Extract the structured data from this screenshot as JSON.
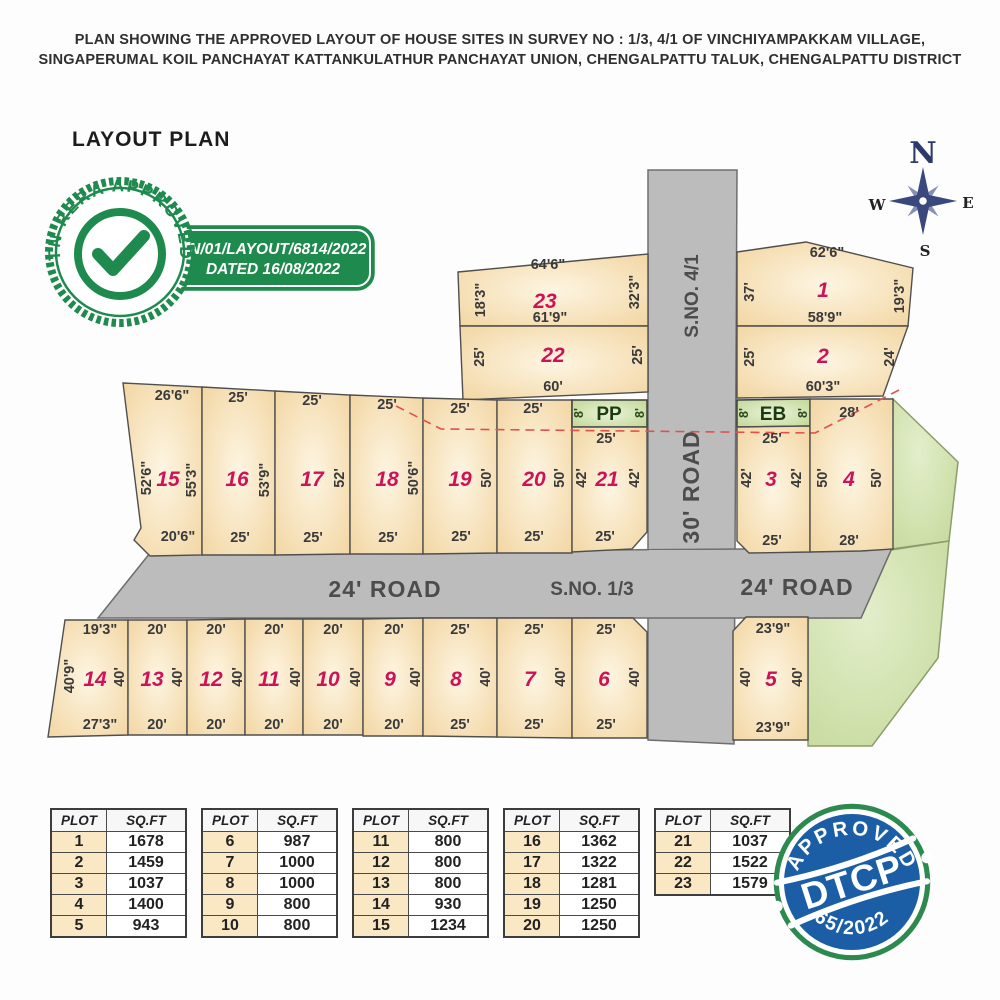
{
  "header": {
    "line1": "PLAN SHOWING THE APPROVED LAYOUT OF HOUSE SITES IN SURVEY NO : 1/3, 4/1 OF VINCHIYAMPAKKAM VILLAGE,",
    "line2": "SINGAPERUMAL KOIL PANCHAYAT KATTANKULATHUR PANCHAYAT UNION, CHENGALPATTU TALUK, CHENGALPATTU DISTRICT"
  },
  "layout_title": "LAYOUT PLAN",
  "rera": {
    "seal_text": "TN RERA APPROVED",
    "line1": "TN/01/LAYOUT/6814/2022",
    "line2": "DATED 16/08/2022"
  },
  "dtcp": {
    "approved": "APPROVED",
    "name": "DTCP",
    "number": "65/2022"
  },
  "compass": {
    "n": "N",
    "e": "E",
    "s": "S",
    "w": "W"
  },
  "roads": {
    "survey_41": "S.NO. 4/1",
    "road_30": "30' ROAD",
    "road_24_left": "24' ROAD",
    "survey_13": "S.NO. 1/3",
    "road_24_right": "24' ROAD"
  },
  "strips": {
    "pp": {
      "label": "PP",
      "left": "8'",
      "right": "8'"
    },
    "eb": {
      "label": "EB",
      "left": "8'",
      "right": "8'"
    }
  },
  "plots": {
    "p1": {
      "no": "1",
      "top": "62'6\"",
      "left": "37'",
      "right": "19'3\"",
      "bottom": "58'9\""
    },
    "p2": {
      "no": "2",
      "left": "25'",
      "right": "24'",
      "bottom": "60'3\""
    },
    "p3": {
      "no": "3",
      "top": "25'",
      "left": "42'",
      "right": "42'",
      "bottom": "25'"
    },
    "p4": {
      "no": "4",
      "top": "28'",
      "left": "50'",
      "right": "50'",
      "bottom": "28'"
    },
    "p5": {
      "no": "5",
      "top": "23'9\"",
      "left": "40'",
      "right": "40'",
      "bottom": "23'9\""
    },
    "p6": {
      "no": "6",
      "top": "25'",
      "right": "40'",
      "bottom": "25'"
    },
    "p7": {
      "no": "7",
      "top": "25'",
      "right": "40'",
      "bottom": "25'"
    },
    "p8": {
      "no": "8",
      "top": "25'",
      "right": "40'",
      "bottom": "25'"
    },
    "p9": {
      "no": "9",
      "top": "20'",
      "right": "40'",
      "bottom": "20'"
    },
    "p10": {
      "no": "10",
      "top": "20'",
      "right": "40'",
      "bottom": "20'"
    },
    "p11": {
      "no": "11",
      "top": "20'",
      "right": "40'",
      "bottom": "20'"
    },
    "p12": {
      "no": "12",
      "top": "20'",
      "right": "40'",
      "bottom": "20'"
    },
    "p13": {
      "no": "13",
      "top": "20'",
      "right": "40'",
      "bottom": "20'"
    },
    "p14": {
      "no": "14",
      "top": "19'3\"",
      "left": "40'9\"",
      "right": "40'",
      "bottom": "27'3\""
    },
    "p15": {
      "no": "15",
      "top": "26'6\"",
      "left": "52'6\"",
      "right": "55'3\"",
      "bottom": "20'6\""
    },
    "p16": {
      "no": "16",
      "top": "25'",
      "right": "53'9\"",
      "bottom": "25'"
    },
    "p17": {
      "no": "17",
      "top": "25'",
      "right": "52'",
      "bottom": "25'"
    },
    "p18": {
      "no": "18",
      "top": "25'",
      "right": "50'6\"",
      "bottom": "25'"
    },
    "p19": {
      "no": "19",
      "top": "25'",
      "right": "50'",
      "bottom": "25'"
    },
    "p20": {
      "no": "20",
      "top": "25'",
      "right": "50'",
      "bottom": "25'"
    },
    "p21": {
      "no": "21",
      "top": "25'",
      "left": "42'",
      "right": "42'",
      "bottom": "25'"
    },
    "p22": {
      "no": "22",
      "left": "25'",
      "right": "25'",
      "bottom": "60'"
    },
    "p23": {
      "no": "23",
      "top": "64'6\"",
      "left": "18'3\"",
      "right": "32'3\"",
      "bottom": "61'9\""
    }
  },
  "tables": [
    {
      "headers": [
        "PLOT",
        "SQ.FT"
      ],
      "rows": [
        [
          "1",
          "1678"
        ],
        [
          "2",
          "1459"
        ],
        [
          "3",
          "1037"
        ],
        [
          "4",
          "1400"
        ],
        [
          "5",
          "943"
        ]
      ]
    },
    {
      "headers": [
        "PLOT",
        "SQ.FT"
      ],
      "rows": [
        [
          "6",
          "987"
        ],
        [
          "7",
          "1000"
        ],
        [
          "8",
          "1000"
        ],
        [
          "9",
          "800"
        ],
        [
          "10",
          "800"
        ]
      ]
    },
    {
      "headers": [
        "PLOT",
        "SQ.FT"
      ],
      "rows": [
        [
          "11",
          "800"
        ],
        [
          "12",
          "800"
        ],
        [
          "13",
          "800"
        ],
        [
          "14",
          "930"
        ],
        [
          "15",
          "1234"
        ]
      ]
    },
    {
      "headers": [
        "PLOT",
        "SQ.FT"
      ],
      "rows": [
        [
          "16",
          "1362"
        ],
        [
          "17",
          "1322"
        ],
        [
          "18",
          "1281"
        ],
        [
          "19",
          "1250"
        ],
        [
          "20",
          "1250"
        ]
      ]
    },
    {
      "headers": [
        "PLOT",
        "SQ.FT"
      ],
      "rows": [
        [
          "21",
          "1037"
        ],
        [
          "22",
          "1522"
        ],
        [
          "23",
          "1579"
        ]
      ]
    }
  ],
  "colors": {
    "plot_number": "#ce1257",
    "rera_green": "#1f8a4d",
    "dtcp_blue": "#1b5ea6",
    "plot_fill": "#f4d9a6",
    "road_gray": "#bcbcbc",
    "green_area": "#cde0a8",
    "boundary_dashed_red": "#e0504f"
  }
}
